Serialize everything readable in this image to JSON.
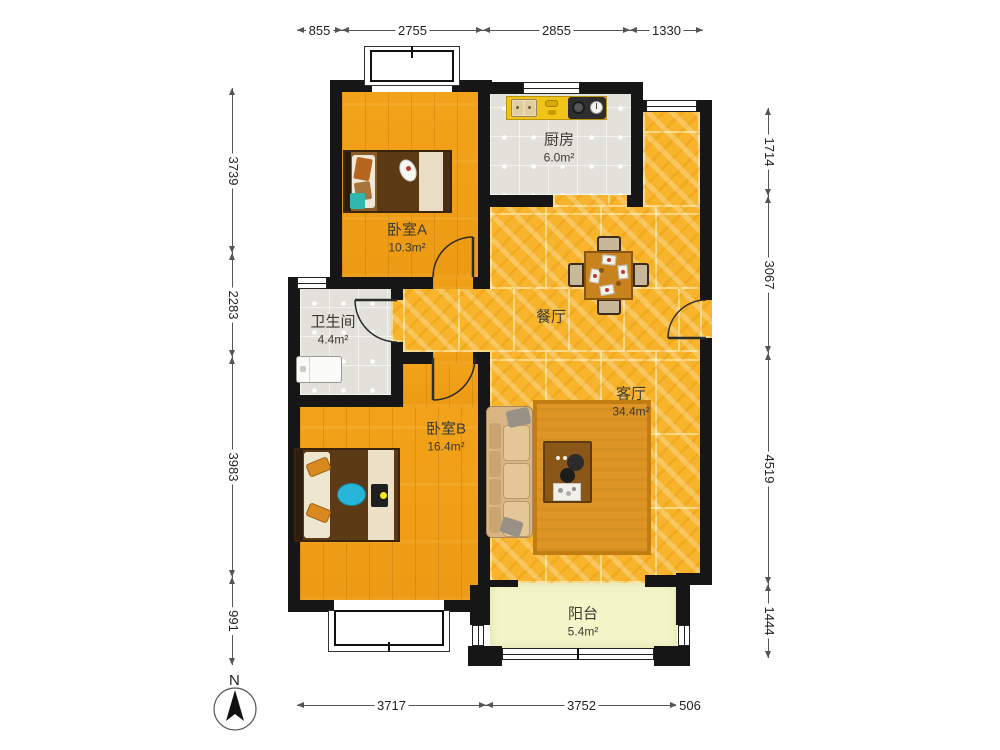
{
  "rooms": {
    "kitchen": {
      "name": "厨房",
      "area": "6.0m²"
    },
    "bedroomA": {
      "name": "卧室A",
      "area": "10.3m²"
    },
    "bathroom": {
      "name": "卫生间",
      "area": "4.4m²"
    },
    "dining": {
      "name": "餐厅"
    },
    "living": {
      "name": "客厅",
      "area": "34.4m²"
    },
    "bedroomB": {
      "name": "卧室B",
      "area": "16.4m²"
    },
    "balcony": {
      "name": "阳台",
      "area": "5.4m²"
    }
  },
  "dimensions": {
    "top": [
      "855",
      "2755",
      "2855",
      "1330"
    ],
    "left": [
      "3739",
      "2283",
      "3983",
      "991"
    ],
    "right": [
      "1714",
      "3067",
      "4519",
      "1444"
    ],
    "bottom": [
      "3717",
      "3752",
      "506"
    ]
  },
  "compass": {
    "north_label": "N"
  },
  "colors": {
    "wall": "#161616",
    "wood_floor": "#EE9D15",
    "marble_floor": "#F7B42C",
    "tile_floor": "#E2E2DA",
    "balcony_floor": "#F4F6CA",
    "counter": "#F2C417"
  }
}
